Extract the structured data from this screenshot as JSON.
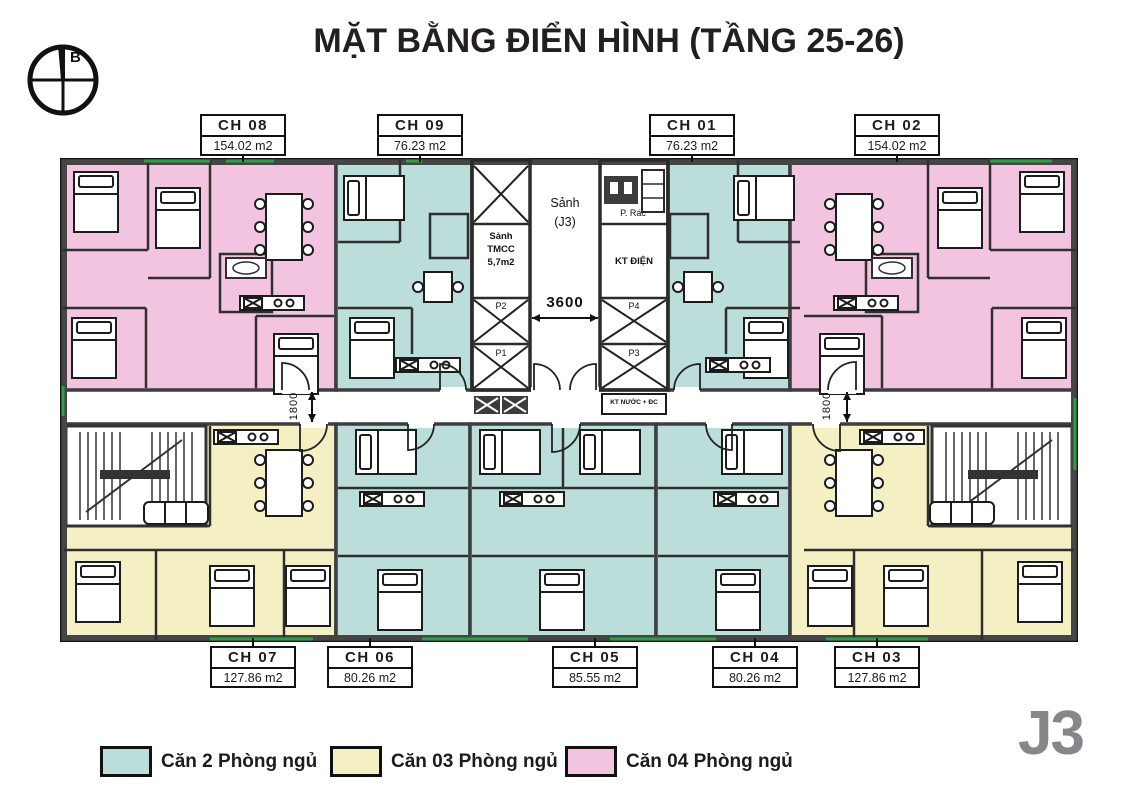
{
  "title": "MẶT BẰNG ĐIỂN HÌNH (TẦNG 25-26)",
  "compass": {
    "north": "B"
  },
  "building_code": "J3",
  "apartments": {
    "top": [
      {
        "id": "CH 08",
        "area": "154.02 m2",
        "type": "4-bedroom"
      },
      {
        "id": "CH 09",
        "area": "76.23 m2",
        "type": "2-bedroom"
      },
      {
        "id": "CH 01",
        "area": "76.23 m2",
        "type": "2-bedroom"
      },
      {
        "id": "CH 02",
        "area": "154.02 m2",
        "type": "4-bedroom"
      }
    ],
    "bottom": [
      {
        "id": "CH 07",
        "area": "127.86 m2",
        "type": "3-bedroom"
      },
      {
        "id": "CH 06",
        "area": "80.26 m2",
        "type": "2-bedroom"
      },
      {
        "id": "CH 05",
        "area": "85.55 m2",
        "type": "2-bedroom"
      },
      {
        "id": "CH 04",
        "area": "80.26 m2",
        "type": "2-bedroom"
      },
      {
        "id": "CH 03",
        "area": "127.86 m2",
        "type": "3-bedroom"
      }
    ]
  },
  "core": {
    "lobby_name": "Sảnh",
    "lobby_block": "(J3)",
    "service_lobby": [
      "Sảnh",
      "TMCC",
      "5,7m2"
    ],
    "trash_room": "P. Rác",
    "electrical": "KT ĐIỆN",
    "water_tech": "KT NƯỚC + ĐC",
    "elevators": {
      "p1": "P1",
      "p2": "P2",
      "p3": "P3",
      "p4": "P4"
    }
  },
  "dimensions": {
    "lobby_width": "3600",
    "corridor_left": "1800",
    "corridor_right": "1800"
  },
  "legend": [
    {
      "label": "Căn 2 Phòng ngủ",
      "color": "#bcdedb"
    },
    {
      "label": "Căn 03 Phòng ngủ",
      "color": "#f4f0c3"
    },
    {
      "label": "Căn 04 Phòng ngủ",
      "color": "#f2c4df"
    }
  ],
  "colors": {
    "two_bed": "#bcdedb",
    "three_bed": "#f4f0c3",
    "four_bed": "#f2c4df",
    "wall": "#3d3d3d",
    "accent_green": "#2f9e48",
    "logo_gray": "#85878a"
  }
}
